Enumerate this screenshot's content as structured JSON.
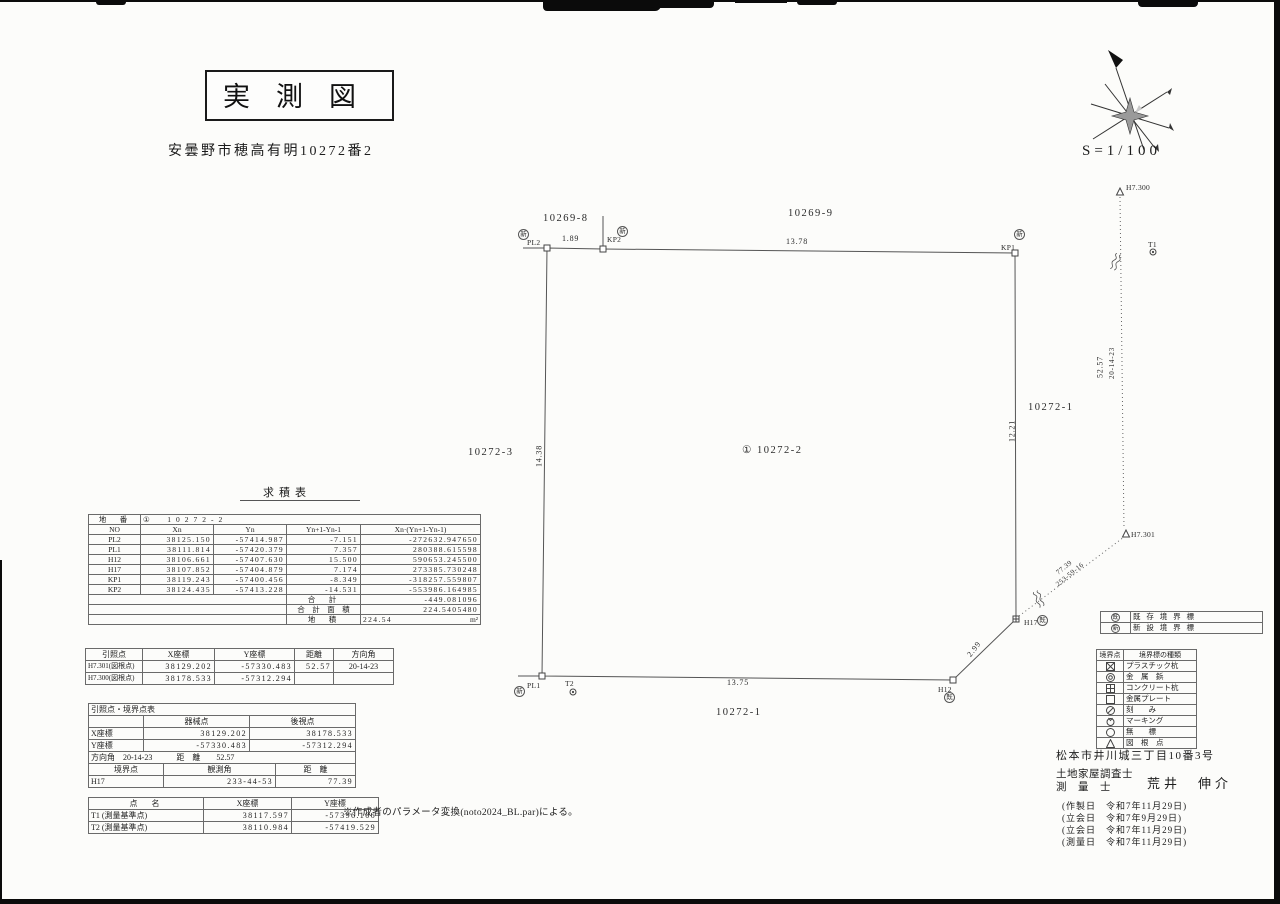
{
  "header": {
    "title": "実測図",
    "address": "安曇野市穂高有明10272番2",
    "scale": "S=1/100"
  },
  "map": {
    "parcels": {
      "top_left": "10269-8",
      "top_right": "10269-9",
      "left": "10272-3",
      "center": "① 10272-2",
      "right": "10272-1",
      "bottom": "10272-1"
    },
    "edges": {
      "top_short": "1.89",
      "top": "13.78",
      "left": "14.38",
      "right": "12.21",
      "corner": "2.99",
      "bottom": "13.75"
    },
    "refs": {
      "v_dist": "52.57",
      "v_angle": "20-14-23",
      "d_dist": "77.39",
      "d_angle": "253-59-16"
    },
    "points": {
      "pl2": {
        "label": "PL2",
        "badge": "新"
      },
      "kp2": {
        "label": "KP2",
        "badge": "新"
      },
      "kp1": {
        "label": "KP1",
        "badge": "新"
      },
      "h17": {
        "label": "H17",
        "badge": "既"
      },
      "h12": {
        "label": "H12",
        "badge": "既"
      },
      "pl1": {
        "label": "PL1",
        "badge": "新"
      },
      "t1": {
        "label": "T1"
      },
      "t2": {
        "label": "T2"
      },
      "h7300": {
        "label": "H7.300"
      },
      "h7301": {
        "label": "H7.301"
      }
    }
  },
  "kyuseki": {
    "title": "求積表",
    "chiban_label": "地　番",
    "chiban_value": "①　10272-2",
    "headers": [
      "NO",
      "Xn",
      "Yn",
      "Yn+1-Yn-1",
      "Xn·(Yn+1-Yn-1)"
    ],
    "rows": [
      [
        "PL2",
        "38125.150",
        "-57414.987",
        "-7.151",
        "-272632.947650"
      ],
      [
        "PL1",
        "38111.814",
        "-57420.379",
        "7.357",
        "280388.615598"
      ],
      [
        "H12",
        "38106.661",
        "-57407.630",
        "15.500",
        "590653.245500"
      ],
      [
        "H17",
        "38107.852",
        "-57404.879",
        "7.174",
        "273385.730248"
      ],
      [
        "KP1",
        "38119.243",
        "-57400.456",
        "-8.349",
        "-318257.559807"
      ],
      [
        "KP2",
        "38124.435",
        "-57413.228",
        "-14.531",
        "-553986.164985"
      ]
    ],
    "sum_label": "合　計",
    "sum_value": "-449.081096",
    "sum_area_label": "合　計　面　積",
    "sum_area_value": "224.5405480",
    "area_label": "地　積",
    "area_value": "224.54",
    "area_unit": "m²"
  },
  "inshoten": {
    "headers": [
      "引照点",
      "X座標",
      "Y座標",
      "距離",
      "方向角"
    ],
    "rows": [
      [
        "H7.301(図根点)",
        "38129.202",
        "-57330.483",
        "52.57",
        "20-14-23"
      ],
      [
        "H7.300(図根点)",
        "38178.533",
        "-57312.294",
        "",
        ""
      ]
    ]
  },
  "kyokaiten": {
    "title": "引照点・境界点表",
    "col_machine": "器械点",
    "col_backsight": "後視点",
    "x_label": "X座標",
    "x_machine": "38129.202",
    "x_backsight": "38178.533",
    "y_label": "Y座標",
    "y_machine": "-57330.483",
    "y_backsight": "-57312.294",
    "angle_row": "方向角　20-14-23　　　距　離　　52.57",
    "bp_headers": [
      "境界点",
      "観測角",
      "距　離"
    ],
    "bp_row": [
      "H17",
      "233-44-53",
      "77.39"
    ]
  },
  "tenmei": {
    "headers": [
      "点　名",
      "X座標",
      "Y座標"
    ],
    "rows": [
      [
        "T1 (測量基準点)",
        "38117.597",
        "-57396.106"
      ],
      [
        "T2 (測量基準点)",
        "38110.984",
        "-57419.529"
      ]
    ]
  },
  "note": "※作成者のパラメータ変換(noto2024_BL.par)による。",
  "legend_existing": {
    "rows": [
      {
        "symbol": "既",
        "label": "既 存 境 界 標"
      },
      {
        "symbol": "新",
        "label": "新 設 境 界 標"
      }
    ]
  },
  "legend_types": {
    "header": [
      "境界点",
      "境界標の種類"
    ],
    "rows": [
      {
        "symbol": "plastic-stake",
        "label": "プラスチック杭"
      },
      {
        "symbol": "metal-pin",
        "label": "金　属　鋲"
      },
      {
        "symbol": "concrete-stake",
        "label": "コンクリート杭"
      },
      {
        "symbol": "metal-plate",
        "label": "金属プレート"
      },
      {
        "symbol": "notch",
        "label": "刻　　み"
      },
      {
        "symbol": "marking",
        "label": "マーキング"
      },
      {
        "symbol": "no-marker",
        "label": "無　　標"
      },
      {
        "symbol": "map-control-point",
        "label": "図　根　点"
      }
    ]
  },
  "surveyor": {
    "address": "松本市井川城三丁目10番3号",
    "role1": "土地家屋調査士",
    "role2": "測　量　士",
    "name": "荒井　伸介",
    "dates": [
      "(作製日　令和7年11月29日)",
      "(立会日　令和7年9月29日)",
      "(立会日　令和7年11月29日)",
      "(測量日　令和7年11月29日)"
    ]
  }
}
